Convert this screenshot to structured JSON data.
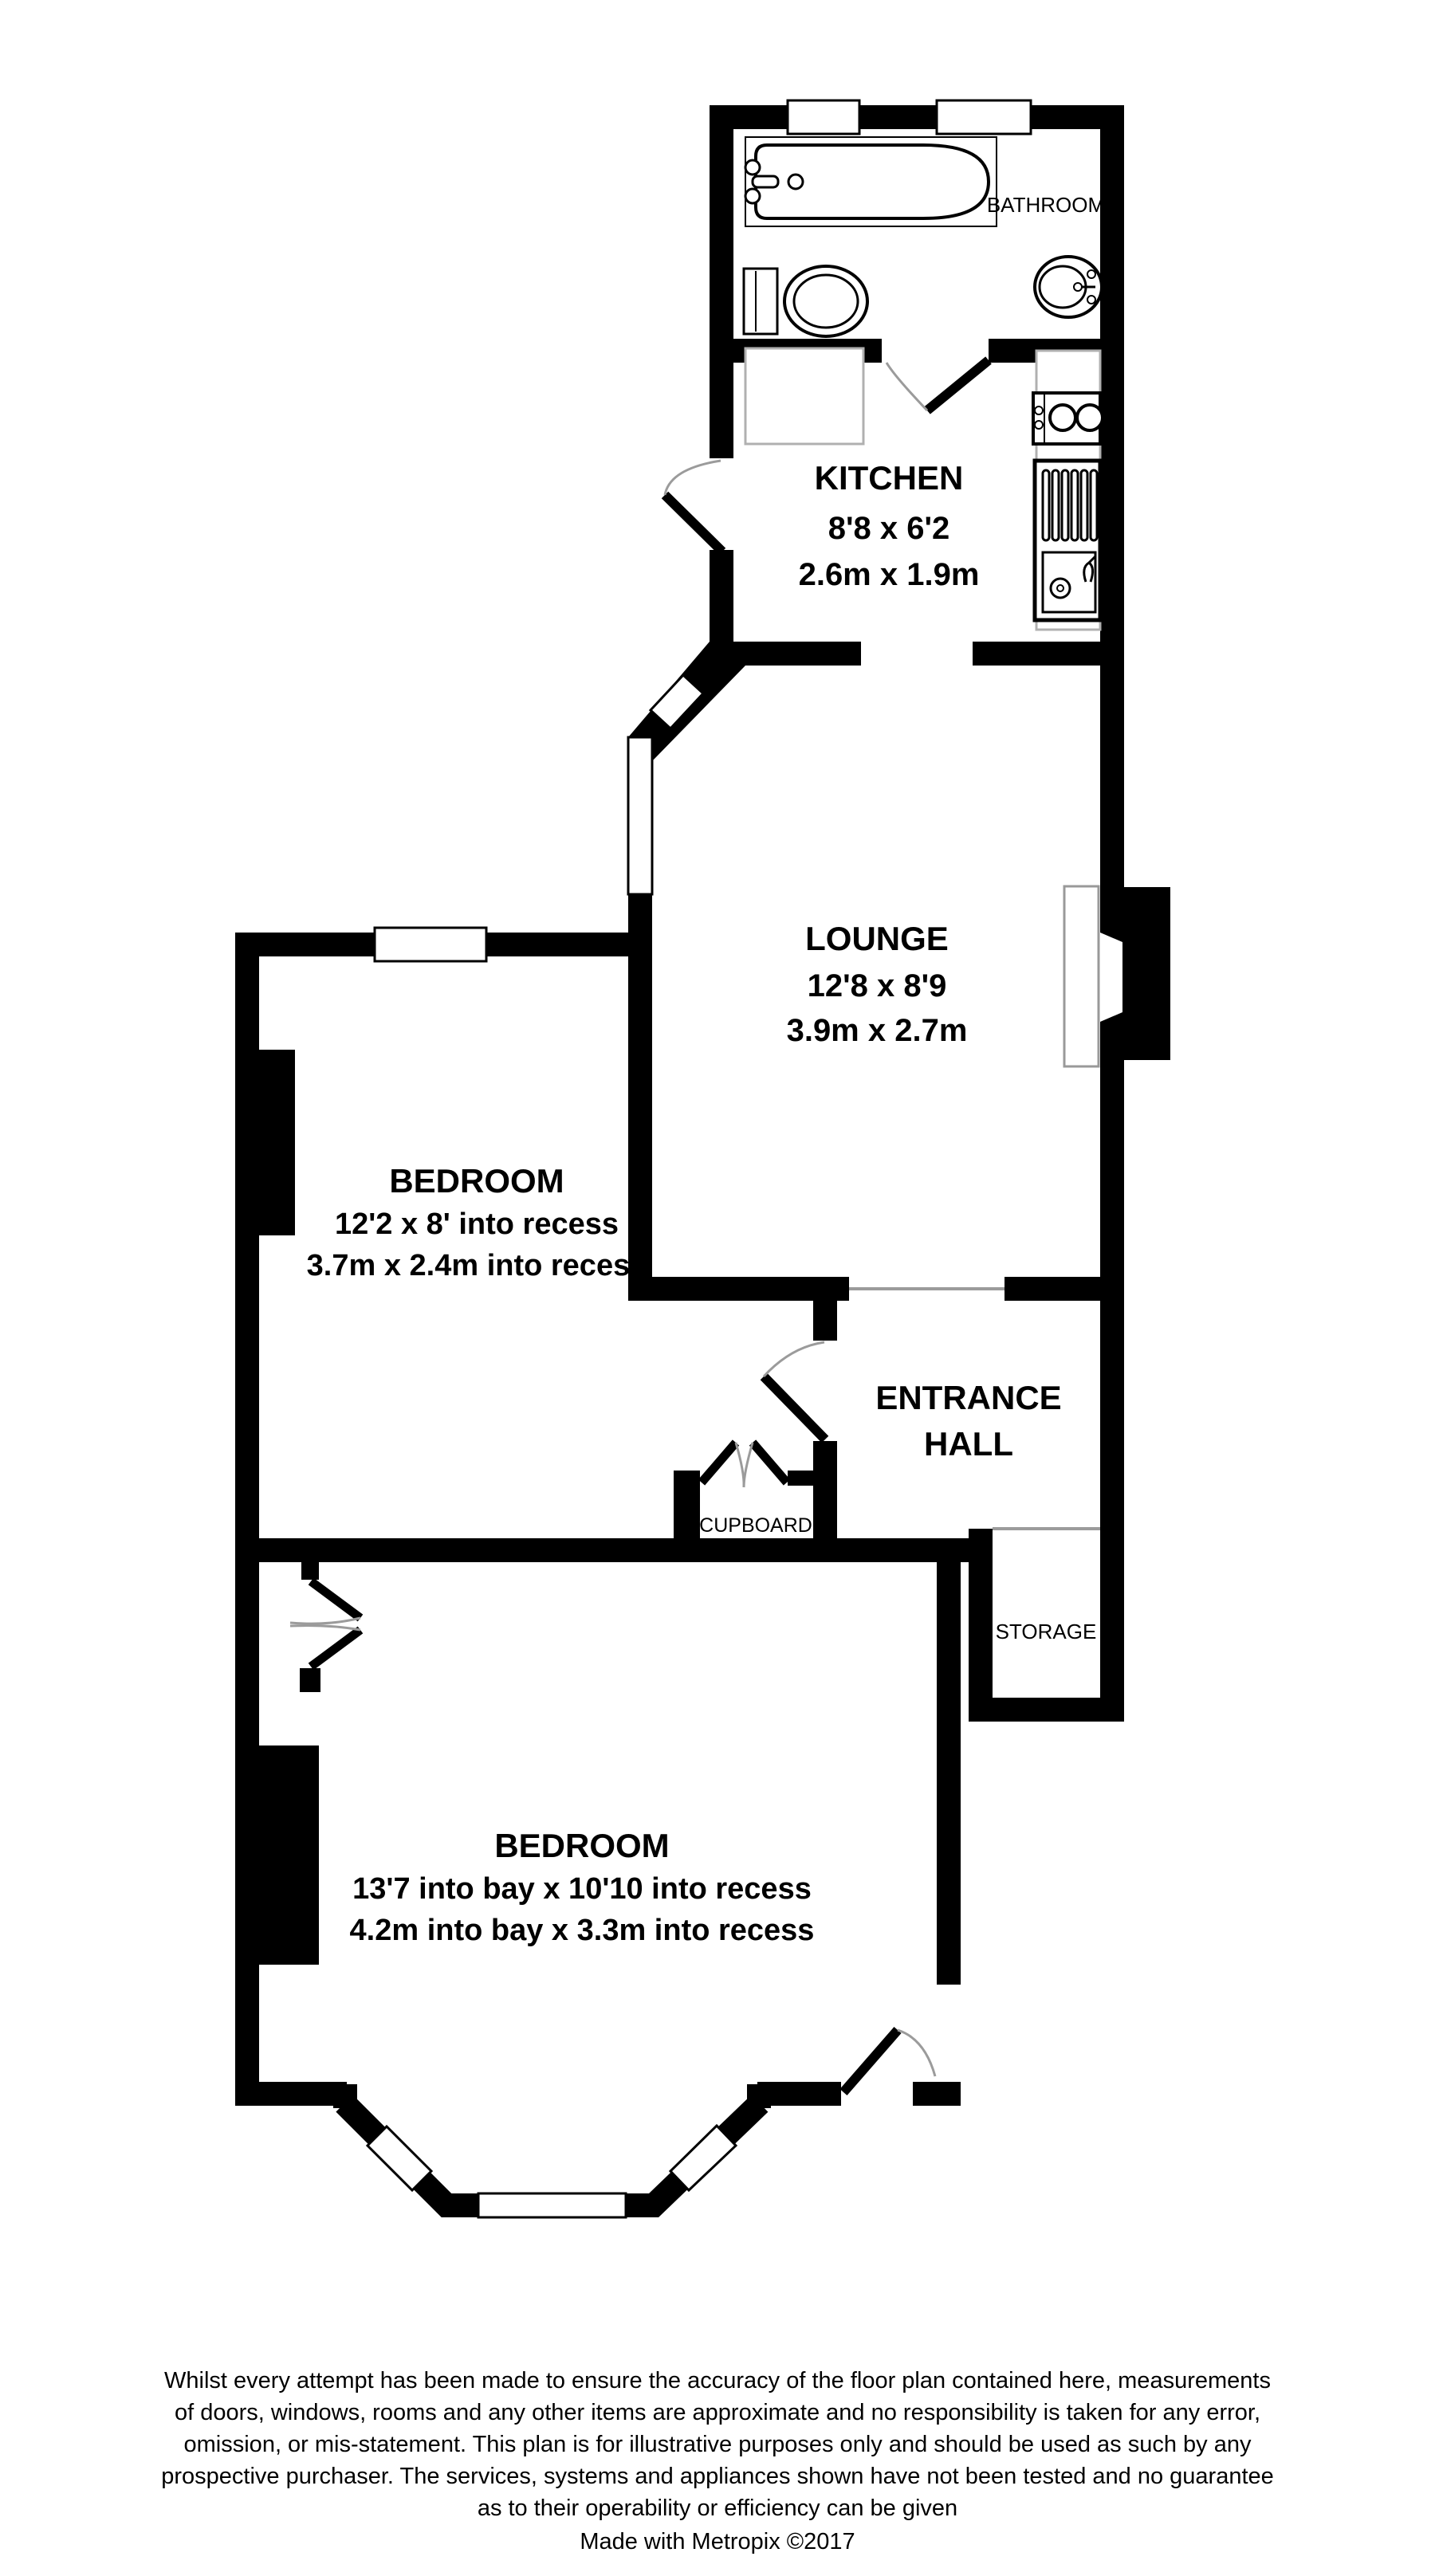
{
  "plan": {
    "rooms": {
      "bathroom": {
        "label": "BATHROOM"
      },
      "kitchen": {
        "name": "KITCHEN",
        "imperial": "8'8 x 6'2",
        "metric": "2.6m x 1.9m"
      },
      "lounge": {
        "name": "LOUNGE",
        "imperial": "12'8 x 8'9",
        "metric": "3.9m x 2.7m"
      },
      "bedroom1": {
        "name": "BEDROOM",
        "imperial": "12'2 x 8' into recess",
        "metric": "3.7m x 2.4m into recess"
      },
      "entrance_hall": {
        "line1": "ENTRANCE",
        "line2": "HALL"
      },
      "cupboard": {
        "label": "CUPBOARD"
      },
      "storage": {
        "label": "STORAGE"
      },
      "bedroom2": {
        "name": "BEDROOM",
        "imperial": "13'7 into bay x 10'10 into recess",
        "metric": "4.2m into bay x 3.3m into recess"
      }
    },
    "disclaimer": {
      "line1": "Whilst every attempt has been made to ensure the accuracy of the floor plan contained here, measurements",
      "line2": "of doors, windows, rooms and any other items are approximate and no responsibility is taken for any error,",
      "line3": "omission, or mis-statement. This plan is for illustrative purposes only and should be used as such by any",
      "line4": "prospective purchaser. The services, systems and appliances shown have not been tested and no guarantee",
      "line5": "as to their operability or efficiency can be given"
    },
    "credit": "Made with Metropix ©2017",
    "colors": {
      "wall": "#000000",
      "opening_line": "#9b9b9b",
      "hearth_stroke": "#999999"
    }
  }
}
